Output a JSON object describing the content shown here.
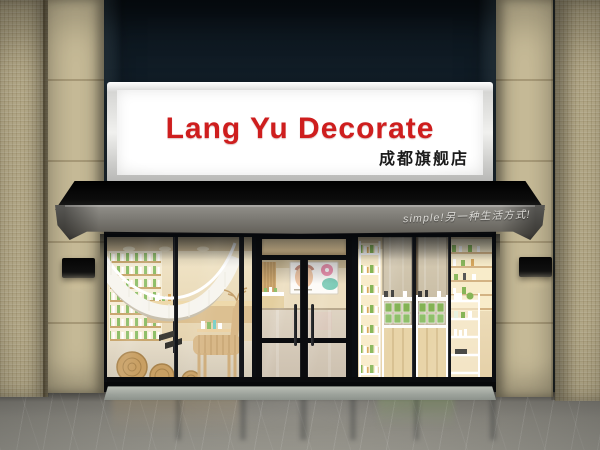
{
  "sign": {
    "title": "Lang Yu Decorate",
    "subtitle": "成都旗舰店"
  },
  "awning": {
    "tagline": "simple!另一种生活方式!"
  },
  "colors": {
    "sign_text": "#ce1e1e",
    "sign_panel": "#f3f3f1",
    "awning_top": "#0b0b0c",
    "awning_fabric": "#7b7973",
    "tile": "#c9bd99",
    "frame_black": "#0c0e12",
    "interior_warm": "#efe2c2",
    "product_green": "#84b457",
    "top_panel": "#13212c",
    "floor": "#8b8980",
    "threshold": "#9da39c"
  }
}
